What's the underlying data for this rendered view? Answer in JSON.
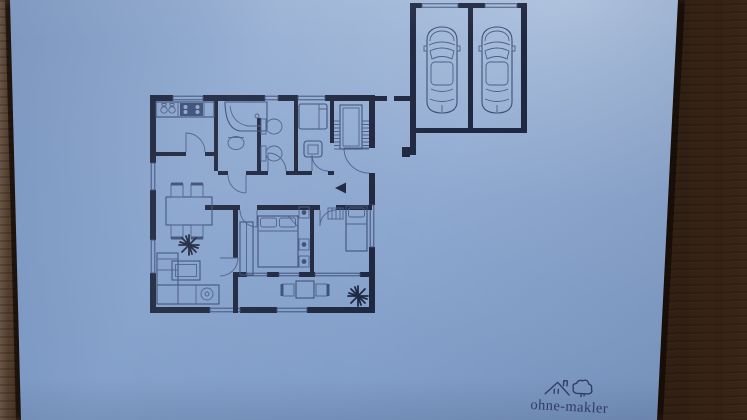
{
  "scene": {
    "description": "Photograph of a blue-print style apartment floor plan on paper lying on a dark wooden table",
    "logo": {
      "text": "ohne-makler",
      "icon": "house-and-cloud-icon"
    },
    "colors": {
      "paper_light": "#aec2de",
      "paper_mid": "#8fa9d0",
      "paper_dark": "#7b9ac7",
      "ink": "#1f2840",
      "ink_mid": "#3d5078",
      "ink_soft": "#4c5f88",
      "logo_ink": "#33426b",
      "wood_light": "#6e5a49",
      "wood_dark": "#241610",
      "shadow": "#120a05"
    },
    "floor_plan": {
      "areas": [
        "kitchen",
        "bathroom",
        "wc",
        "small-bedroom",
        "staircase",
        "hallway",
        "dining-living-room",
        "master-bedroom",
        "second-bedroom",
        "terrace",
        "double-garage"
      ],
      "furniture_symbols": [
        "kitchen-counter-with-sink-and-stove",
        "corner-bathtub",
        "washbasin",
        "toilet",
        "bidet",
        "single-bed",
        "armchair",
        "dining-table-with-4-chairs",
        "corner-sofa",
        "coffee-table",
        "double-bed-with-nightstands",
        "wardrobe",
        "terrace-table-with-2-chairs"
      ],
      "cars_in_garage": 2,
      "plants": 2,
      "entrance_arrow": "points-left"
    }
  }
}
